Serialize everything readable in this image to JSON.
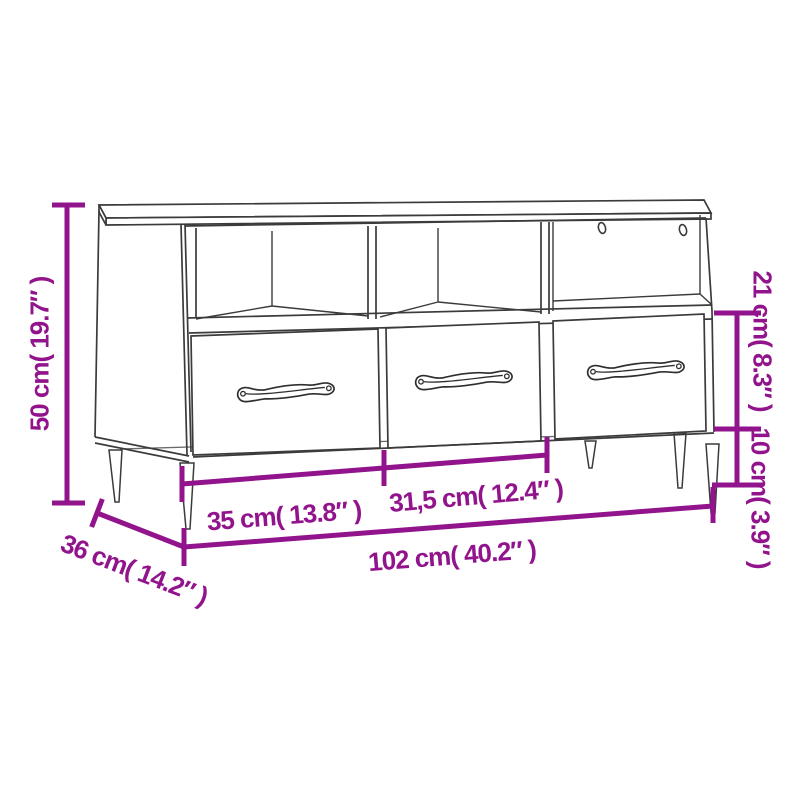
{
  "figure": {
    "title": "TV cabinet dimension diagram",
    "accent_color": "#92148c",
    "line_color": "#3b3b3b",
    "background_color": "#ffffff"
  },
  "dimensions": {
    "height": "50 cm( 19.7″ )",
    "compartment_height": "21 cm( 8.3″ )",
    "leg_clearance": "10 cm( 3.9″ )",
    "drawer_width_left": "35 cm( 13.8″ )",
    "drawer_width_middle": "31,5 cm( 12.4″ )",
    "total_width": "102 cm( 40.2″ )",
    "depth": "36 cm( 14.2″ )"
  }
}
